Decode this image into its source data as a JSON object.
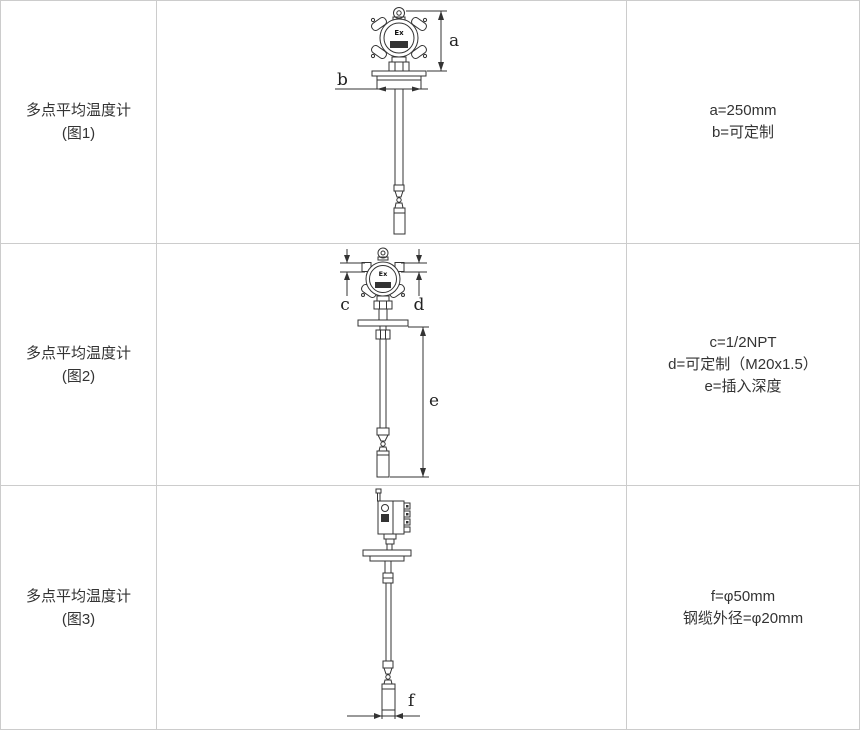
{
  "page": {
    "border_color": "#cccccc",
    "line_color": "#333333",
    "text_color": "#333333"
  },
  "rows": [
    {
      "name": "多点平均温度计",
      "figure_no": "(图1)",
      "specs": [
        "a=250mm",
        "b=可定制"
      ],
      "diagram": {
        "ex_label": "Ex",
        "dims": {
          "a": "a",
          "b": "b"
        }
      }
    },
    {
      "name": "多点平均温度计",
      "figure_no": "(图2)",
      "specs": [
        "c=1/2NPT",
        "d=可定制（M20x1.5）",
        "e=插入深度"
      ],
      "diagram": {
        "ex_label": "Ex",
        "dims": {
          "c": "c",
          "d": "d",
          "e": "e"
        }
      }
    },
    {
      "name": "多点平均温度计",
      "figure_no": "(图3)",
      "specs": [
        "f=φ50mm",
        "钢缆外径=φ20mm"
      ],
      "diagram": {
        "dims": {
          "f": "f"
        }
      }
    }
  ]
}
